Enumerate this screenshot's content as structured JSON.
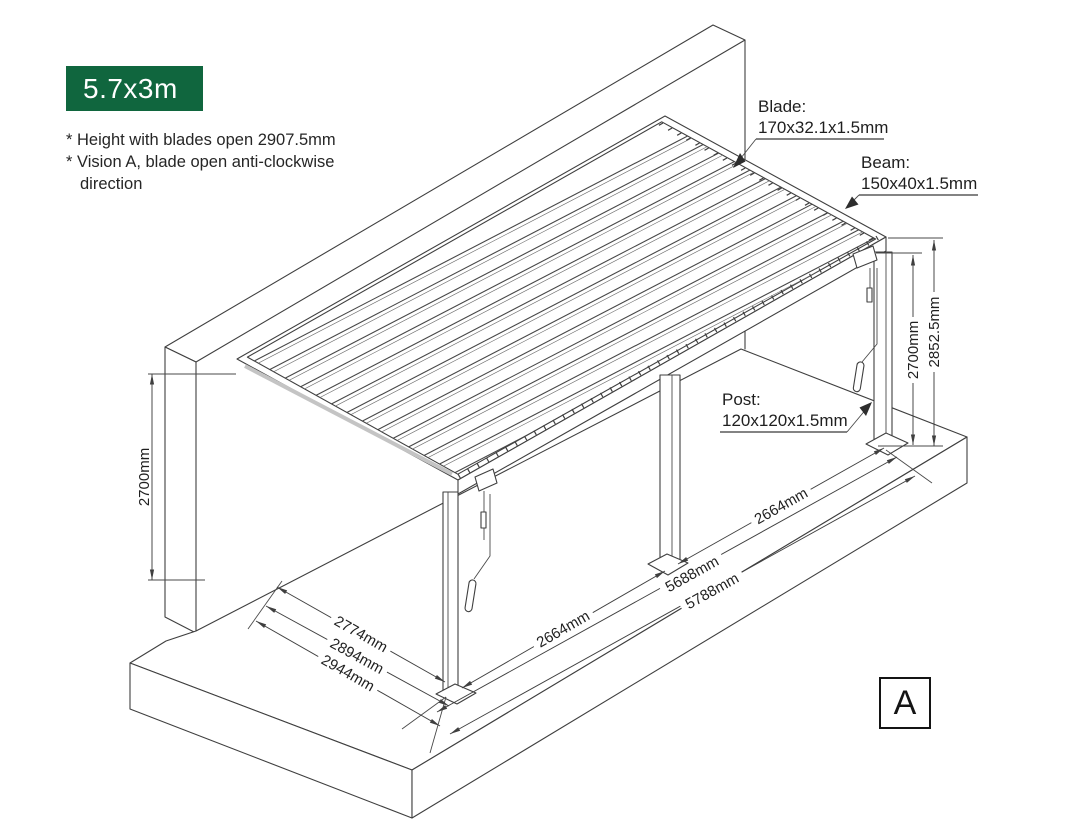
{
  "badge": {
    "label": "5.7x3m",
    "bg_color": "#10663E"
  },
  "notes": {
    "line1": "* Height with blades open 2907.5mm",
    "line2": "* Vision A, blade open anti-clockwise",
    "line3": "direction"
  },
  "callouts": {
    "blade": {
      "title": "Blade:",
      "size": "170x32.1x1.5mm"
    },
    "beam": {
      "title": "Beam:",
      "size": "150x40x1.5mm"
    },
    "post": {
      "title": "Post:",
      "size": "120x120x1.5mm"
    }
  },
  "dimensions": {
    "left_height": "2700mm",
    "right_height_clear": "2700mm",
    "right_height_total": "2852.5mm",
    "front_left_bay": "2664mm",
    "front_right_bay": "2664mm",
    "front_posts_span": "5688mm",
    "front_total_span": "5788mm",
    "side_depth_inner": "2774mm",
    "side_depth_mid": "2894mm",
    "side_depth_outer": "2944mm"
  },
  "view_marker": {
    "label": "A"
  },
  "colors": {
    "accent_green": "#10663E",
    "line": "#3f3f3f",
    "text": "#1f1f1f"
  }
}
